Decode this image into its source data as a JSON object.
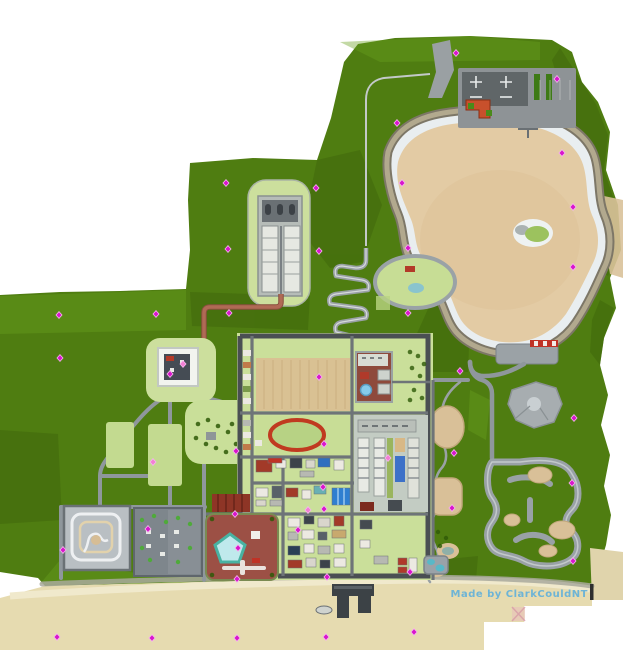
{
  "credit": {
    "text": "Made by  ClarkCouldNT",
    "color": "#6db4d6"
  },
  "palette": {
    "land_green": "#4f7d11",
    "dark_green": "#3f660b",
    "light_green": "#6aa01e",
    "pale_green": "#ccdf9d",
    "lake_sand": "#e3cba4",
    "beach_sand": "#e6dbb0",
    "rim_white": "#e9eef0",
    "road_gray": "#8f979c",
    "ring_road": "#4a4f53",
    "brick_road": "#b06a55",
    "plaza_red": "#9c5045",
    "track_red": "#c03a20",
    "pool_teal": "#49b2a2",
    "marker_magenta": "#d816cc",
    "marker_pink": "#f27fd4"
  },
  "markers": {
    "color": "#d816cc",
    "pink": "#f27fd4",
    "halo": "#f6b8ee",
    "points": [
      {
        "x": 456,
        "y": 53
      },
      {
        "x": 557,
        "y": 79
      },
      {
        "x": 397,
        "y": 123
      },
      {
        "x": 562,
        "y": 153
      },
      {
        "x": 402,
        "y": 183
      },
      {
        "x": 316,
        "y": 188
      },
      {
        "x": 226,
        "y": 183
      },
      {
        "x": 573,
        "y": 207
      },
      {
        "x": 408,
        "y": 248
      },
      {
        "x": 228,
        "y": 249
      },
      {
        "x": 319,
        "y": 251
      },
      {
        "x": 573,
        "y": 267
      },
      {
        "x": 408,
        "y": 313
      },
      {
        "x": 59,
        "y": 315
      },
      {
        "x": 156,
        "y": 314
      },
      {
        "x": 229,
        "y": 313
      },
      {
        "x": 60,
        "y": 358
      },
      {
        "x": 183,
        "y": 364,
        "v": "pink"
      },
      {
        "x": 170,
        "y": 374
      },
      {
        "x": 319,
        "y": 377
      },
      {
        "x": 460,
        "y": 371
      },
      {
        "x": 574,
        "y": 418
      },
      {
        "x": 324,
        "y": 444
      },
      {
        "x": 236,
        "y": 451
      },
      {
        "x": 454,
        "y": 453
      },
      {
        "x": 388,
        "y": 458,
        "v": "pink"
      },
      {
        "x": 153,
        "y": 462,
        "v": "pink"
      },
      {
        "x": 572,
        "y": 483
      },
      {
        "x": 323,
        "y": 487
      },
      {
        "x": 452,
        "y": 508
      },
      {
        "x": 308,
        "y": 510,
        "v": "pink"
      },
      {
        "x": 324,
        "y": 509
      },
      {
        "x": 235,
        "y": 514
      },
      {
        "x": 298,
        "y": 530
      },
      {
        "x": 148,
        "y": 529
      },
      {
        "x": 238,
        "y": 548
      },
      {
        "x": 63,
        "y": 550
      },
      {
        "x": 573,
        "y": 561
      },
      {
        "x": 410,
        "y": 572
      },
      {
        "x": 327,
        "y": 577
      },
      {
        "x": 237,
        "y": 579
      },
      {
        "x": 57,
        "y": 637
      },
      {
        "x": 152,
        "y": 638
      },
      {
        "x": 237,
        "y": 638
      },
      {
        "x": 326,
        "y": 637
      },
      {
        "x": 414,
        "y": 632
      }
    ]
  }
}
